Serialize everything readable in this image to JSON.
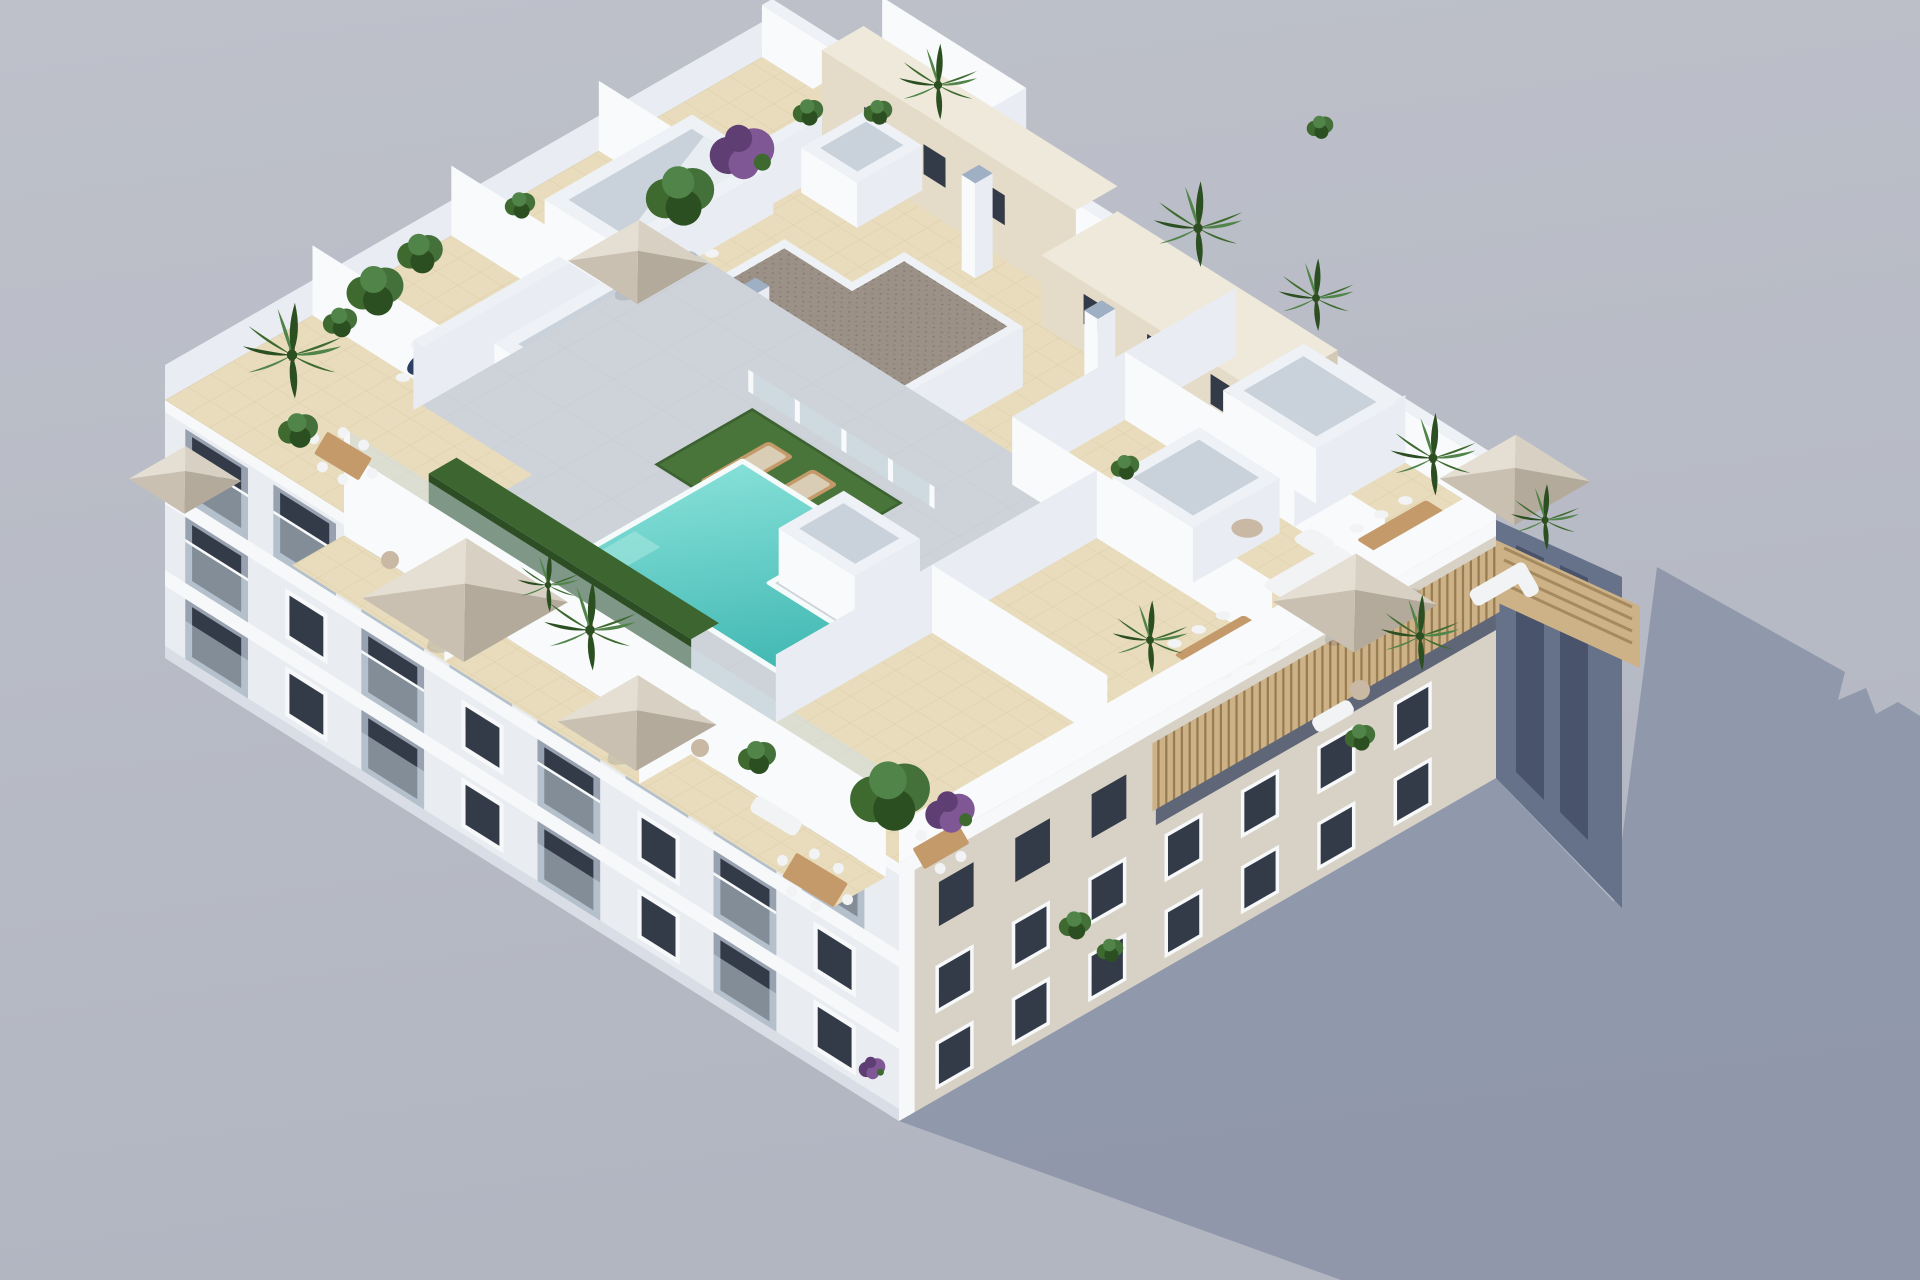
{
  "scene": {
    "type": "3d-architectural-rendering",
    "subject": "aerial isometric view of a white apartment block with a communal rooftop: T-shaped turquoise pool, artificial-grass sunbathing areas, private tiled terraces divided by white walls, beige parasols, wooden dining sets, palms and bougainvillea; long shadow cast to the lower right",
    "objects": {
      "parasols": 6,
      "skylight_wells": 6,
      "chimney_pillars": 5,
      "dining_tables": 7,
      "sun_loungers": 2,
      "facades_visible": [
        "southwest",
        "southeast",
        "northeast-sliver"
      ]
    }
  },
  "colors": {
    "bg_top": "#bec1ca",
    "bg_bottom": "#b2b6c1",
    "shadow": "#8d95a9",
    "tile": "#e8dcbc",
    "tile_line": "#cdbc92",
    "deck": "#ced3d9",
    "deck_line": "#b9c0c8",
    "wall_lit": "#f8fafc",
    "wall_shaded": "#e9edf3",
    "wall_cap": "#eef1f5",
    "cap_gray": "#9fb0c4",
    "glass": "#cfe0e8",
    "pool_light": "#85e0d8",
    "pool_deep": "#3db5b0",
    "pool_edge": "#f4fbfa",
    "grass": "#49753b",
    "hedge": "#2d4e24",
    "hedge_top": "#3c6530",
    "brown": "#9c9187",
    "brown_dot": "#857b72",
    "beige_wall": "#e4dbc9",
    "beige_wall_dark": "#d4c9b5",
    "beige_top": "#efe9dc",
    "sw_facade": "#e9ecf0",
    "sw_facade_dark": "#d9dee6",
    "se_facade": "#d8d2c6",
    "recess": "#98a1b0",
    "window": "#343b48",
    "trim": "#f6f8fa",
    "ne_sliver": "#66718a",
    "ne_col": "#49536b",
    "wood": "#c59a6a",
    "wood_dark": "#9a7a50",
    "slat": "#cdb187",
    "slat_line": "#977c52",
    "umb_l1": "#e5ded2",
    "umb_l2": "#d8d0c3",
    "umb_m": "#c9c0b2",
    "umb_d": "#b4aa9b",
    "chair": "#f2f3f4",
    "palm1": "#3e6a2f",
    "palm2": "#2c4f21",
    "palm3": "#518449",
    "bush": "#44703a",
    "purple": "#7e5794",
    "purple_d": "#5f3f73",
    "pot": "#c9b9a4",
    "navy": "#2c3f63"
  }
}
